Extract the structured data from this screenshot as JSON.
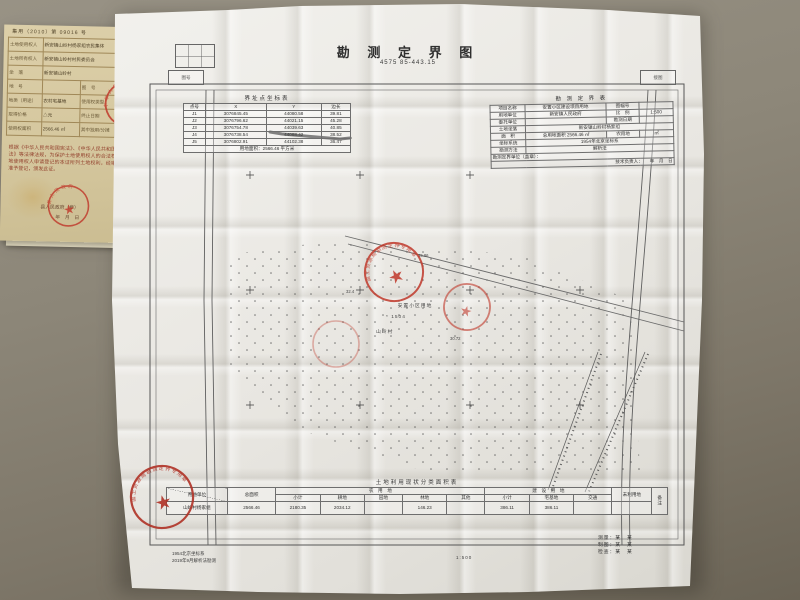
{
  "certificate": {
    "serial": "集用（2010）第 09016 号",
    "table": {
      "rows": [
        {
          "label": "土地使用权人",
          "value": "新安镇山岭村杨家组农民集体",
          "label2": "",
          "value2": ""
        },
        {
          "label": "土地所有权人",
          "value": "新安镇山岭村村民委员会",
          "label2": "",
          "value2": ""
        },
        {
          "label": "坐　落",
          "value": "新安镇山岭村",
          "label2": "",
          "value2": ""
        },
        {
          "label": "地　号",
          "value": "",
          "label2": "图　号",
          "value2": "8-42-101-8"
        },
        {
          "label": "地类（用途）",
          "value": "农村宅基地",
          "label2": "使用权类型",
          "value2": "集体"
        },
        {
          "label": "取得价格",
          "value": "△元",
          "label2": "终止日期",
          "value2": ""
        },
        {
          "label": "使用权面积",
          "value": "2566.46 ㎡",
          "label2": "其中独用/分摊",
          "value2": "㎡"
        }
      ]
    },
    "statement": "根据《中华人民共和国宪法》、《中华人民共和国土地管理法》等法律法规，为保护土地使用权人的合法权益，对土地使用权人申请登记的本证所列土地权利，经审查核实，准予登记，颁发此证。",
    "issuer": "县人民政府（章）",
    "date": "年　月　日"
  },
  "map": {
    "title": "勘 测 定 界 图",
    "subtitle": "4575 85-443.15",
    "corner_box_left": "图号",
    "corner_box_right": "接图",
    "coord_table": {
      "caption": "界址点坐标表",
      "headers": [
        "点号",
        "X",
        "Y",
        "边长"
      ],
      "rows": [
        [
          "J1",
          "3076845.45",
          "44080.58",
          "39.81"
        ],
        [
          "J2",
          "3076796.62",
          "44021.15",
          "45.28"
        ],
        [
          "J3",
          "3076754.78",
          "44039.63",
          "40.85"
        ],
        [
          "J4",
          "3076738.54",
          "44088.42",
          "38.52"
        ],
        [
          "J5",
          "3076802.91",
          "44102.38",
          "36.47"
        ]
      ],
      "footer": "用地面积：2566.46 平方米"
    },
    "info_table": {
      "caption": "勘 测 定 界 表",
      "rows": [
        {
          "label": "项目名称",
          "value": "安置小区建设项目用地",
          "label2": "图幅号",
          "value2": ""
        },
        {
          "label": "用地单位",
          "value": "新安镇人民政府",
          "label2": "比　例",
          "value2": "1:500"
        },
        {
          "label": "委托单位",
          "value": "",
          "label2": "勘测日期",
          "value2": ""
        },
        {
          "label": "土地坐落",
          "value": "新安镇山岭村杨家组",
          "label2": "",
          "value2": ""
        },
        {
          "label": "面　积",
          "value": "总用地面积 2566.46 ㎡",
          "label2": "农用地",
          "value2": "㎡"
        },
        {
          "label": "坐标系统",
          "value": "1954年北京坐标系",
          "label2": "",
          "value2": ""
        },
        {
          "label": "勘测方法",
          "value": "解析法",
          "label2": "",
          "value2": ""
        }
      ],
      "footer1": "勘测定界单位（盖章）：",
      "footer2": "技术负责人：　　年　月　日"
    },
    "landuse_table": {
      "caption": "土地利用现状分类面积表",
      "unit_header": "用地单位",
      "group_headers": [
        "总面积",
        "农　用　地",
        "建　设　用　地",
        "未利用地"
      ],
      "sub_headers": [
        "小计",
        "耕地",
        "园地",
        "林地",
        "其他",
        "小计",
        "宅基地",
        "交通"
      ],
      "note_header": "备注",
      "row": {
        "unit": "山岭村杨家组",
        "total": "2566.46",
        "nys_total": "2180.35",
        "gd": "2034.12",
        "yd": "",
        "ld": "146.23",
        "qt": "",
        "js_total": "386.11",
        "zjd": "386.11",
        "jt": "",
        "wly": "",
        "note": ""
      }
    },
    "notes": [
      "1954北京坐标系",
      "2019年9月解析法勘测"
    ],
    "scale": "1:500",
    "sign_block": [
      {
        "label": "测量：",
        "value": "某　某"
      },
      {
        "label": "制图：",
        "value": "某　某"
      },
      {
        "label": "检查：",
        "value": "某　某"
      }
    ],
    "labels": {
      "site": "安置小区用地",
      "veg": "* 1504",
      "village": "山岭村",
      "elev1": "35.86",
      "elev2": "32.4",
      "elev3": "30.72"
    }
  },
  "stamps": {
    "star": "★",
    "ring_map": "国土资源局勘测定界专用章",
    "ring_gov": "县人民政府",
    "ring_national": "中华人民共和国"
  }
}
